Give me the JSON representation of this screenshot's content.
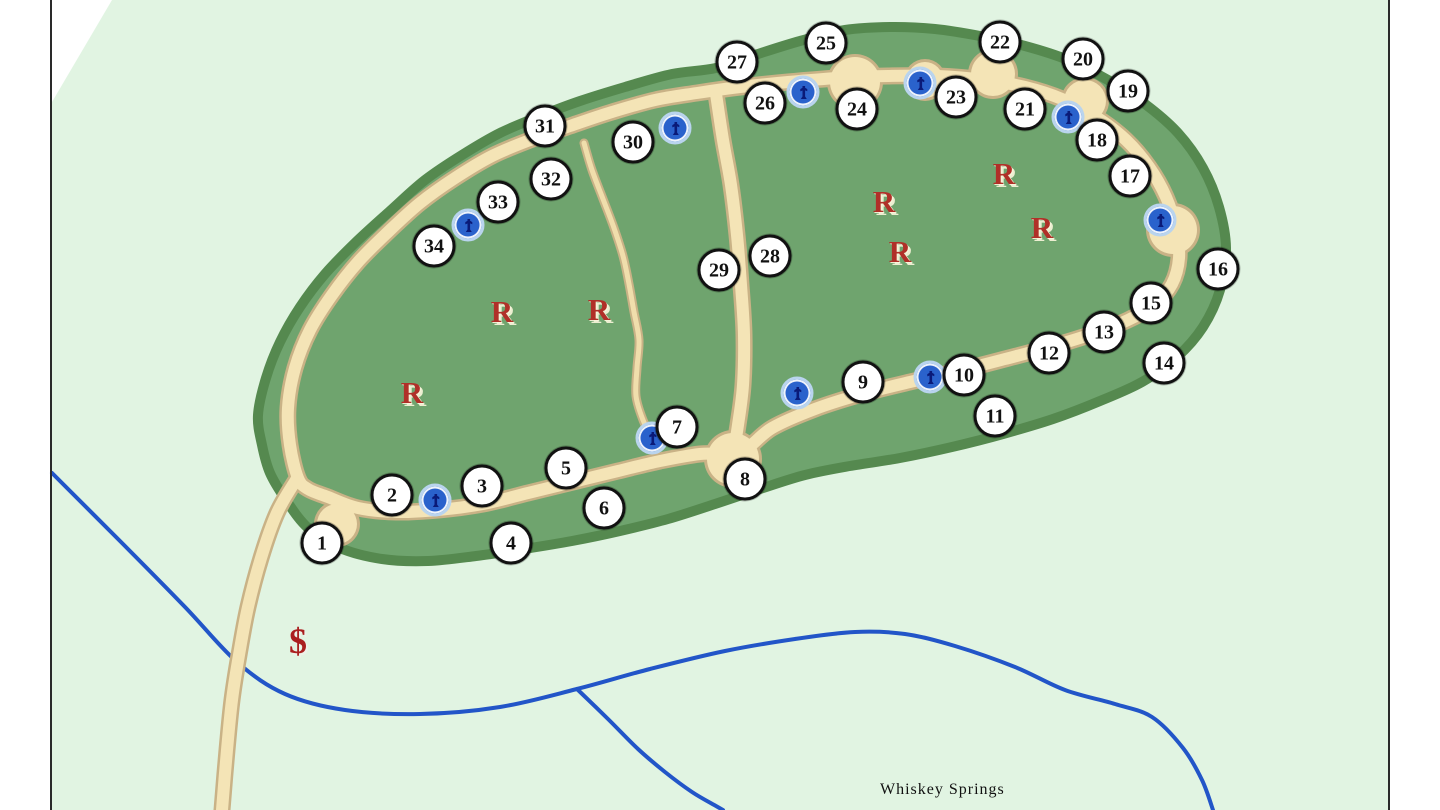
{
  "map": {
    "stream_label": "Whiskey Springs",
    "restroom_symbol": "R",
    "fee_symbol": "$",
    "colors": {
      "map_background": "#e1f4e2",
      "outside_background": "#ffffff",
      "map_border": "#2a2a2a",
      "campground_fill": "#6fa46e",
      "campground_edge": "#55894f",
      "road_fill": "#f4e4b6",
      "road_edge": "#c9b286",
      "trail_fill": "#f0deac",
      "stream": "#2255c8",
      "marker_fill": "#ffffff",
      "marker_border": "#111111",
      "restroom_color": "#b03028",
      "fee_color": "#aa1f1f",
      "water_disc": "#2a62cc",
      "water_ring": "#b9d4ee",
      "water_glyph": "#0a1a78",
      "label_color": "#111111"
    },
    "campsites": [
      {
        "number": "1",
        "x": 322,
        "y": 543
      },
      {
        "number": "2",
        "x": 392,
        "y": 495
      },
      {
        "number": "3",
        "x": 482,
        "y": 486
      },
      {
        "number": "4",
        "x": 511,
        "y": 543
      },
      {
        "number": "5",
        "x": 566,
        "y": 468
      },
      {
        "number": "6",
        "x": 604,
        "y": 508
      },
      {
        "number": "7",
        "x": 677,
        "y": 427
      },
      {
        "number": "8",
        "x": 745,
        "y": 479
      },
      {
        "number": "9",
        "x": 863,
        "y": 382
      },
      {
        "number": "10",
        "x": 964,
        "y": 375
      },
      {
        "number": "11",
        "x": 995,
        "y": 416
      },
      {
        "number": "12",
        "x": 1049,
        "y": 353
      },
      {
        "number": "13",
        "x": 1104,
        "y": 332
      },
      {
        "number": "14",
        "x": 1164,
        "y": 363
      },
      {
        "number": "15",
        "x": 1151,
        "y": 303
      },
      {
        "number": "16",
        "x": 1218,
        "y": 269
      },
      {
        "number": "17",
        "x": 1130,
        "y": 176
      },
      {
        "number": "18",
        "x": 1097,
        "y": 140
      },
      {
        "number": "19",
        "x": 1128,
        "y": 91
      },
      {
        "number": "20",
        "x": 1083,
        "y": 59
      },
      {
        "number": "21",
        "x": 1025,
        "y": 109
      },
      {
        "number": "22",
        "x": 1000,
        "y": 42
      },
      {
        "number": "23",
        "x": 956,
        "y": 97
      },
      {
        "number": "24",
        "x": 857,
        "y": 109
      },
      {
        "number": "25",
        "x": 826,
        "y": 43
      },
      {
        "number": "26",
        "x": 765,
        "y": 103
      },
      {
        "number": "27",
        "x": 737,
        "y": 62
      },
      {
        "number": "28",
        "x": 770,
        "y": 256
      },
      {
        "number": "29",
        "x": 719,
        "y": 270
      },
      {
        "number": "30",
        "x": 633,
        "y": 142
      },
      {
        "number": "31",
        "x": 545,
        "y": 126
      },
      {
        "number": "32",
        "x": 551,
        "y": 179
      },
      {
        "number": "33",
        "x": 498,
        "y": 202
      },
      {
        "number": "34",
        "x": 434,
        "y": 246
      }
    ],
    "water_pumps": [
      {
        "x": 435,
        "y": 500
      },
      {
        "x": 652,
        "y": 438
      },
      {
        "x": 797,
        "y": 393
      },
      {
        "x": 930,
        "y": 377
      },
      {
        "x": 468,
        "y": 225
      },
      {
        "x": 675,
        "y": 128
      },
      {
        "x": 803,
        "y": 92
      },
      {
        "x": 920,
        "y": 83
      },
      {
        "x": 1068,
        "y": 117
      },
      {
        "x": 1160,
        "y": 220
      }
    ],
    "restrooms": [
      {
        "x": 502,
        "y": 312
      },
      {
        "x": 599,
        "y": 310
      },
      {
        "x": 412,
        "y": 393
      },
      {
        "x": 884,
        "y": 202
      },
      {
        "x": 1004,
        "y": 174
      },
      {
        "x": 900,
        "y": 252
      },
      {
        "x": 1042,
        "y": 228
      }
    ],
    "fee_station": {
      "x": 298,
      "y": 641
    }
  }
}
